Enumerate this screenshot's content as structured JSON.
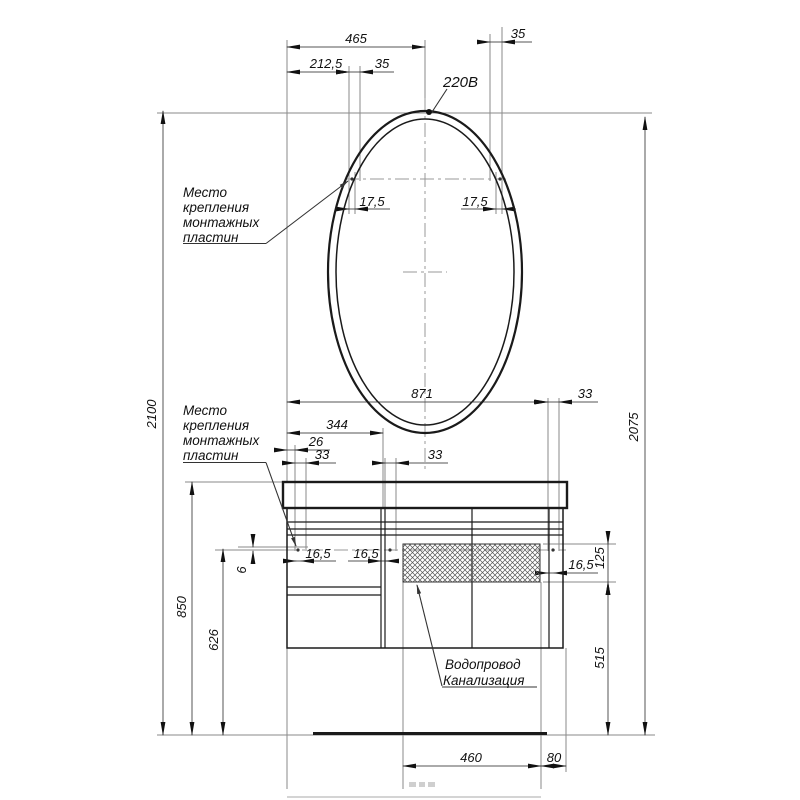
{
  "drawing": {
    "kind": "installation-drawing",
    "language": "ru"
  },
  "notes": {
    "mount_upper": [
      "Место",
      "крепления",
      "монтажных",
      "пластин"
    ],
    "mount_lower": [
      "Место",
      "крепления",
      "монтажных",
      "пластин"
    ],
    "utilities": [
      "Водопровод",
      "Канализация"
    ],
    "socket": "220В"
  },
  "dimensions": {
    "top": {
      "d465": "465",
      "d212_5": "212,5",
      "d35_left": "35",
      "d35_right": "35"
    },
    "mirror": {
      "d17_5_left": "17,5",
      "d17_5_right": "17,5"
    },
    "middle": {
      "d871": "871",
      "d33_right": "33",
      "d344": "344",
      "d26": "26",
      "d33_left": "33",
      "d33_mid": "33"
    },
    "cabinet": {
      "d16_5_a": "16,5",
      "d16_5_b": "16,5",
      "d16_5_c": "16,5",
      "d125": "125",
      "d6": "6"
    },
    "vertical": {
      "d2100": "2100",
      "d850": "850",
      "d626": "626",
      "d2075": "2075",
      "d515": "515"
    },
    "bottom": {
      "d460": "460",
      "d80": "80"
    }
  },
  "colors": {
    "outline": "#1a1a1a",
    "dimension_lines": "#555555",
    "extension_lines": "#8a8a8a",
    "centerlines": "#999999",
    "text": "#111111",
    "background": "#ffffff"
  }
}
